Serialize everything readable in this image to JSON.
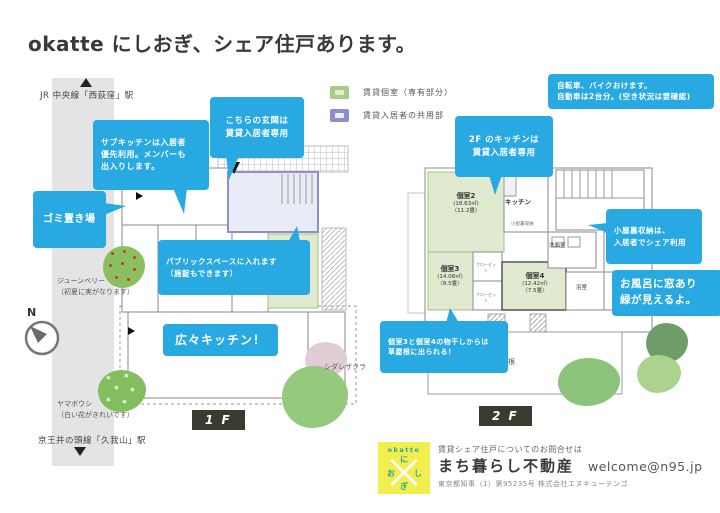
{
  "title": "okatte にしおぎ、シェア住戸あります。",
  "colors": {
    "callout_blue": "#29a9e1",
    "room_green_fill": "#dfead1",
    "room_green_border": "#a2c487",
    "common_fill": "#e9ebf6",
    "common_border": "#8f8ec6",
    "floor_tag_bg": "#3b3a31",
    "logo_yellow": "#f1ee4d",
    "logo_teal": "#27a5a0",
    "road_gray": "#e4e4e4"
  },
  "legend": [
    {
      "label": "賃貸個室（専有部分）"
    },
    {
      "label": "賃貸入居者の共用部"
    }
  ],
  "map": {
    "station_top": "JR 中央線「西荻窪」駅",
    "station_bottom": "京王井の頭線「久我山」駅",
    "compass": "N",
    "trees": {
      "juneberry": "ジューンベリー\n（初夏に実がなります）",
      "yamaboushi": "ヤマボウシ\n（白い花がきれいです）",
      "shidarezakura": "シダレザクラ"
    }
  },
  "callouts": {
    "parking": "自転車、バイクおけます。\n自動車は2台分。(空き状況は要確認)",
    "entrance_1f": "こちらの玄関は\n賃貸入居者専用",
    "sub_kitchen": "サブキッチンは入居者\n優先利用。メンバーも\n出入りします。",
    "garbage": "ゴミ置き場",
    "public_space": "パブリックスペースに入れます\n（施錠もできます）",
    "kitchen_1f": "広々キッチン！",
    "kitchen_2f": "2F のキッチンは\n賃貸入居者専用",
    "attic": "小屋裏収納は、\n入居者でシェア利用",
    "bath_window": "お風呂に窓あり\n緑が見えるよ。",
    "roof_access": "個室3と個室4の物干しからは\n草屋根に出られる！"
  },
  "plans": {
    "f1": {
      "tag": "1 F",
      "room1": {
        "name": "個室1",
        "area": "(13.10㎡)",
        "size": "〈7.9畳〉"
      }
    },
    "f2": {
      "tag": "2 F",
      "room2": {
        "name": "個室2",
        "area": "(18.63㎡)",
        "size": "〈11.2畳〉"
      },
      "room3": {
        "name": "個室3",
        "area": "(14.08㎡)",
        "size": "〈8.5畳〉"
      },
      "room4": {
        "name": "個室4",
        "area": "(12.42㎡)",
        "size": "〈7.5畳〉"
      },
      "kitchen": "キッチン",
      "washroom": "洗面室",
      "bath": "浴室",
      "grass_roof": "草屋根",
      "attic": "小屋裏収納",
      "closet": "クローゼット"
    }
  },
  "footer": {
    "inquiry": "賃貸シェア住戸についてのお問合せは",
    "company": "まち暮らし不動産",
    "email": "welcome@n95.jp",
    "license": "東京都知事（1）第95235号 株式会社エヌキューテンゴ",
    "logo": {
      "word": "okatte",
      "char_top": "に",
      "char_left": "お",
      "char_right": "し",
      "char_bottom": "ぎ"
    }
  }
}
